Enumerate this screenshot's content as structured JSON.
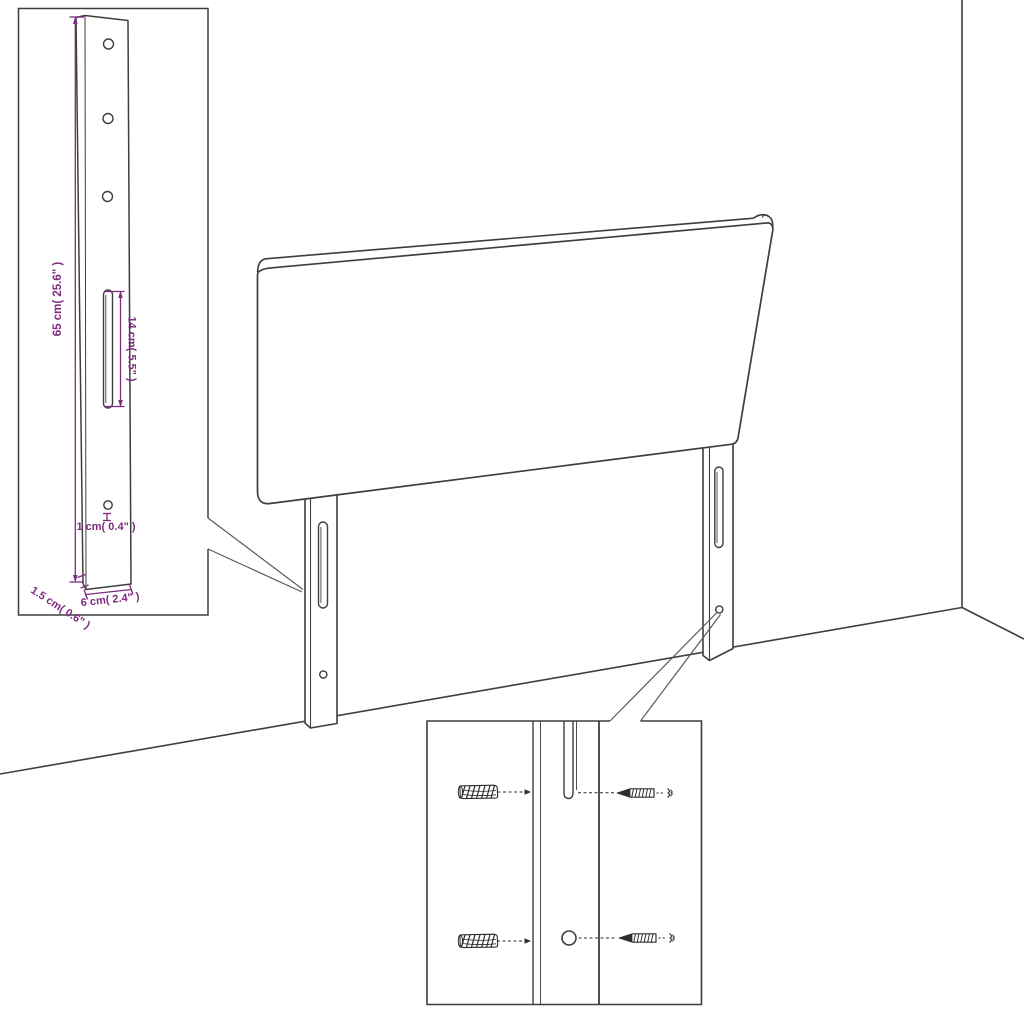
{
  "page": {
    "type": "product-dimension-diagram",
    "subject": "upholstered headboard panel with two slotted mounting legs, wall-corner backdrop, leg detail inset and wall-fixing (plug and screw) detail inset",
    "background": "#ffffff"
  },
  "colors": {
    "outline": "#3e3e3e",
    "leader": "#5a5a5a",
    "dimension_accent": "#7e2a80",
    "hardware": "#2e2e2e"
  },
  "dims": {
    "leg_height": "65 cm( 25.6\" )",
    "slot_length": "14 cm( 5.5\" )",
    "hole_diameter": "1 cm( 0.4\" )",
    "leg_thickness": "1.5 cm( 0.6\" )",
    "leg_width": "6 cm( 2.4\" )"
  }
}
